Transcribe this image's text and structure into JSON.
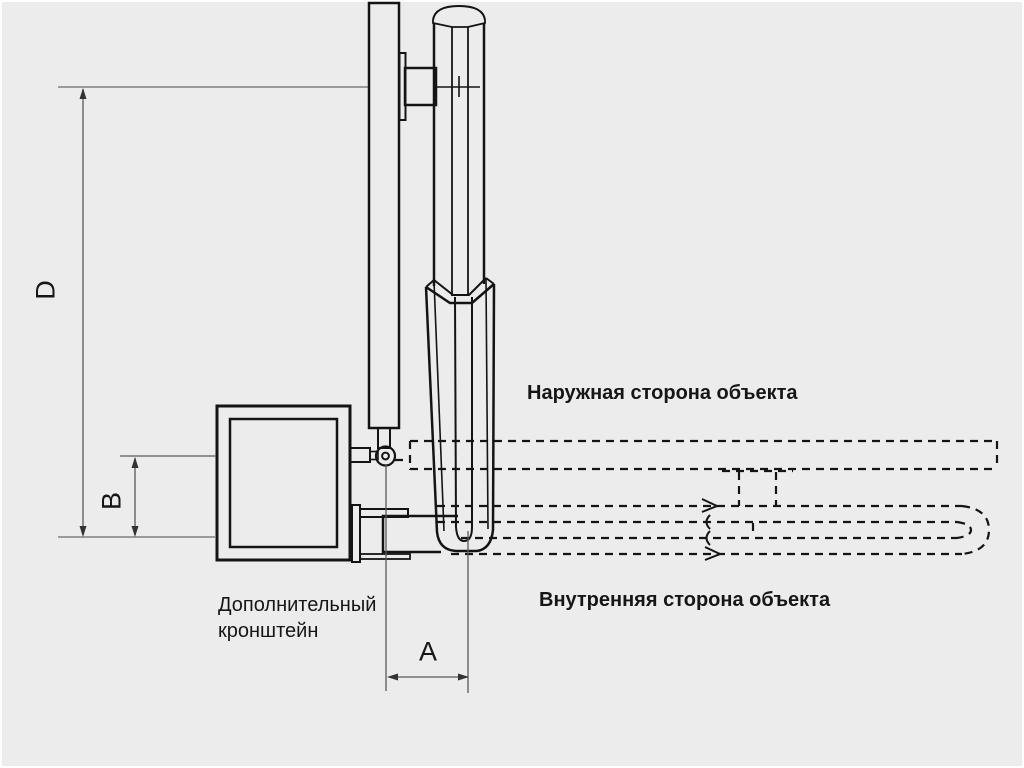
{
  "labels": {
    "outer_side": "Наружная сторона объекта",
    "inner_side": "Внутренняя сторона объекта",
    "bracket_line1": "Дополнительный",
    "bracket_line2": "кронштейн"
  },
  "dimensions": {
    "vertical_main": "D",
    "vertical_secondary": "B",
    "horizontal": "A"
  },
  "colors": {
    "background": "#ececec",
    "outline": "#141414",
    "dimension": "#5a5a5a",
    "reference": "#8f8f8f",
    "text": "#161616"
  }
}
